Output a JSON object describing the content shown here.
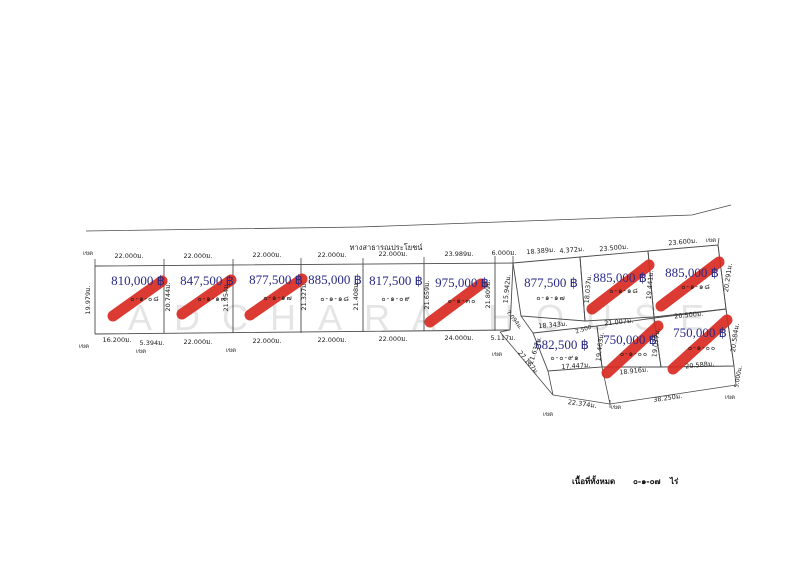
{
  "road_label": "ทางสาธารณประโยชน์",
  "watermark_text": "ADCHARA HOUSE",
  "boundary_label": "เขต",
  "legend": {
    "label": "เนื้อที่ทั้งหมด",
    "value": "๐-๑-๐๗",
    "unit": "ไร่"
  },
  "colors": {
    "price_text": "#2a2a85",
    "sold_mark": "#d92b21",
    "boundary_line": "#4a4a4a"
  },
  "plots": [
    {
      "name": "plot-1",
      "price": "810,000 ฿",
      "area_rai": "๐-๑-๐๘",
      "sold": true
    },
    {
      "name": "plot-2",
      "price": "847,500 ฿",
      "area_rai": "๐-๑-๑๓",
      "sold": true
    },
    {
      "name": "plot-3",
      "price": "877,500 ฿",
      "area_rai": "๐-๑-๑๗",
      "sold": true
    },
    {
      "name": "plot-4",
      "price": "885,000 ฿",
      "area_rai": "๐-๑-๑๘",
      "sold": false
    },
    {
      "name": "plot-5",
      "price": "817,500 ฿",
      "area_rai": "๐-๑-๐๙",
      "sold": false
    },
    {
      "name": "plot-6",
      "price": "975,000 ฿",
      "area_rai": "๐-๑-๓๐",
      "sold": true
    },
    {
      "name": "plot-7",
      "price": "877,500 ฿",
      "area_rai": "๐-๑-๑๗",
      "sold": false
    },
    {
      "name": "plot-8",
      "price": "885,000 ฿",
      "area_rai": "๐-๑-๑๘",
      "sold": true
    },
    {
      "name": "plot-9",
      "price": "885,000 ฿",
      "area_rai": "๐-๑-๑๘",
      "sold": true
    },
    {
      "name": "plot-10",
      "price": "682,500 ฿",
      "area_rai": "๐-๐-๙๑",
      "sold": false
    },
    {
      "name": "plot-11",
      "price": "750,000 ฿",
      "area_rai": "๐-๑-๐๐",
      "sold": true
    },
    {
      "name": "plot-12",
      "price": "750,000 ฿",
      "area_rai": "๐-๑-๐๐",
      "sold": true
    }
  ],
  "dimensions": {
    "top": [
      "22.000ม.",
      "22.000ม.",
      "22.000ม.",
      "22.000ม.",
      "22.000ม.",
      "23.989ม.",
      "6.000ม.",
      "18.389ม.",
      "4.372ม.",
      "23.500ม.",
      "23.600ม."
    ],
    "bottom": [
      "16.200ม.",
      "5.394ม.",
      "22.000ม.",
      "22.000ม.",
      "22.000ม.",
      "22.000ม.",
      "24.000ม.",
      "5.117ม."
    ],
    "side": [
      "19.979ม.",
      "20.744ม.",
      "21.954ม.",
      "21.327ม.",
      "21.408ม.",
      "21.659ม.",
      "21.809ม.",
      "15.942ม.",
      "18.037ม.",
      "19.441ม.",
      "20.291ม.",
      "21.637ม.",
      "19.463ม.",
      "19.077ม.",
      "20.584ม.",
      "5.000ม."
    ],
    "mid": [
      "18.343ม.",
      "21.007ม.",
      "20.500ม.",
      "2.500",
      "17.447ม.",
      "18.916ม.",
      "20.588ม."
    ],
    "diag": [
      "7.094ม.",
      "27.167ม.",
      "22.374ม.",
      "38.250ม."
    ]
  }
}
